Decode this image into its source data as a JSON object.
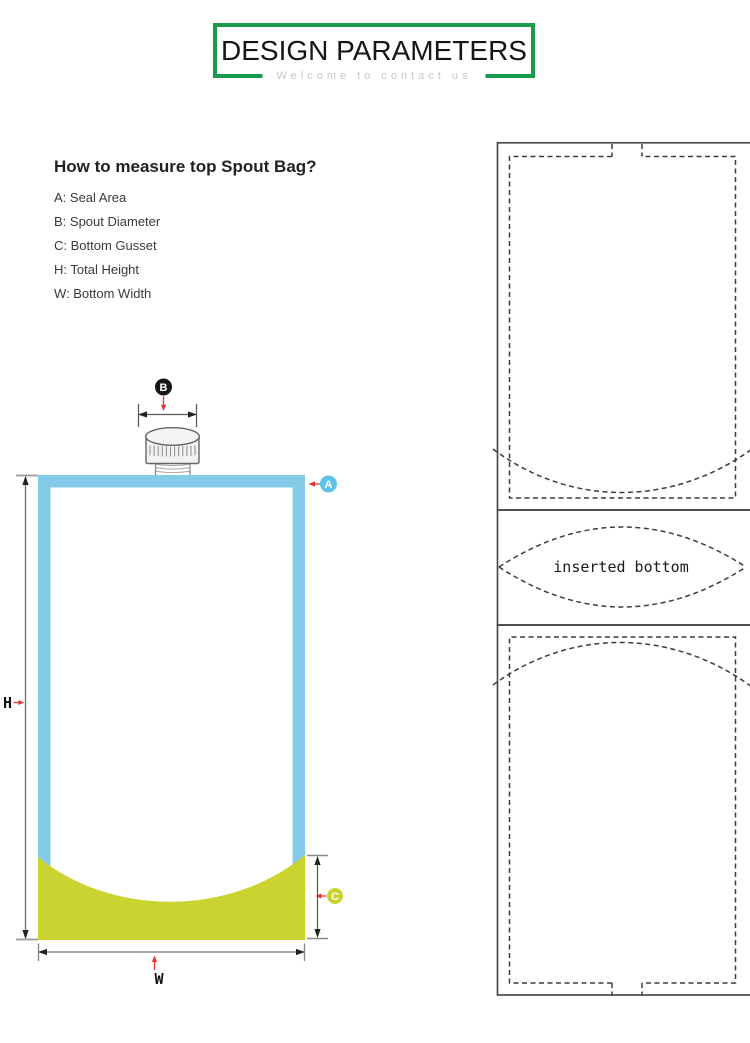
{
  "header": {
    "title": "DESIGN PARAMETERS",
    "subtitle": "Welcome to contact us"
  },
  "instructions": {
    "heading": "How to measure top Spout Bag?",
    "items": [
      "A: Seal Area",
      "B: Spout Diameter",
      "C: Bottom Gusset",
      "H: Total Height",
      "W: Bottom Width"
    ]
  },
  "bag_diagram": {
    "labels": {
      "seal_area": "A",
      "spout_diameter": "B",
      "bottom_gusset": "C",
      "total_height": "H",
      "bottom_width": "W"
    },
    "colors": {
      "header_green": "#189b4c",
      "bag_border_blue": "#85cae8",
      "gusset_yellow": "#cbd331",
      "badge_a_blue": "#5fc2ea",
      "badge_b_black": "#161616",
      "badge_c_yellow": "#cbd331",
      "arrow_red": "#e0342c"
    }
  },
  "panel": {
    "inserted_bottom_label": "inserted bottom"
  }
}
